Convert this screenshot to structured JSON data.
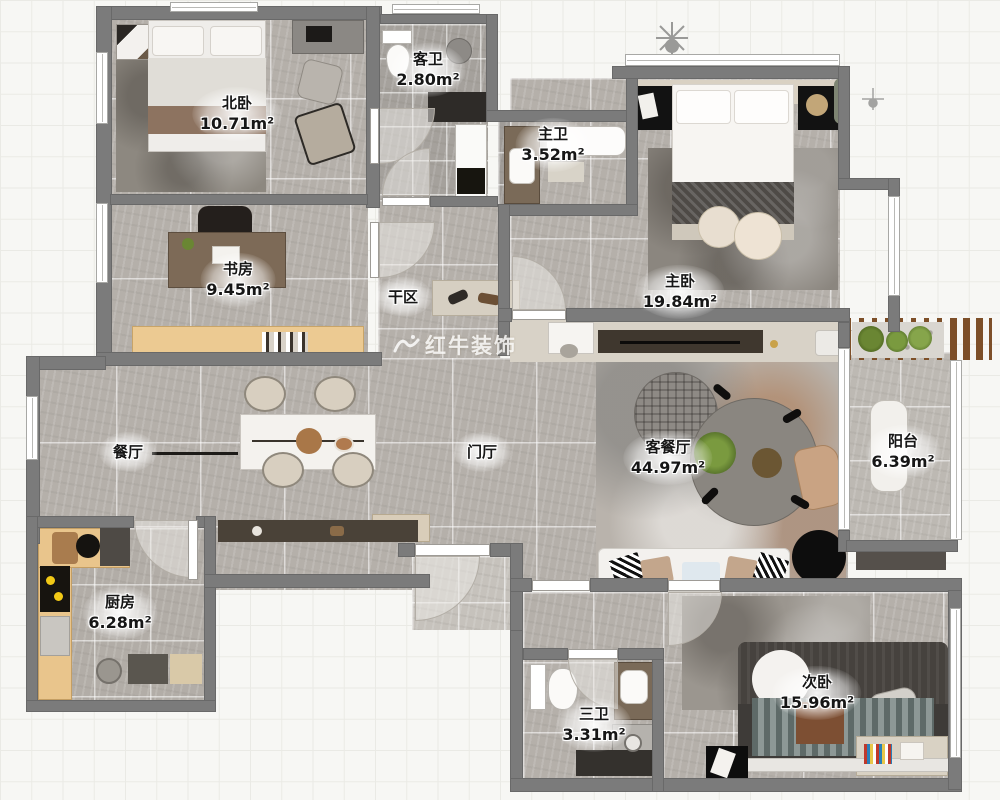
{
  "watermark": {
    "brand": "红牛装饰"
  },
  "rooms": [
    {
      "id": "north-bedroom",
      "label": "北卧",
      "area": "10.71m²"
    },
    {
      "id": "guest-bath",
      "label": "客卫",
      "area": "2.80m²"
    },
    {
      "id": "master-bath",
      "label": "主卫",
      "area": "3.52m²"
    },
    {
      "id": "master-bedroom",
      "label": "主卧",
      "area": "19.84m²"
    },
    {
      "id": "study",
      "label": "书房",
      "area": "9.45m²"
    },
    {
      "id": "dry-area",
      "label": "干区",
      "area": ""
    },
    {
      "id": "dining",
      "label": "餐厅",
      "area": ""
    },
    {
      "id": "foyer",
      "label": "门厅",
      "area": ""
    },
    {
      "id": "living-dining",
      "label": "客餐厅",
      "area": "44.97m²"
    },
    {
      "id": "balcony",
      "label": "阳台",
      "area": "6.39m²"
    },
    {
      "id": "kitchen",
      "label": "厨房",
      "area": "6.28m²"
    },
    {
      "id": "third-bath",
      "label": "三卫",
      "area": "3.31m²"
    },
    {
      "id": "second-bedroom",
      "label": "次卧",
      "area": "15.96m²"
    }
  ],
  "colors": {
    "wall": "#7b7b7b",
    "floor_tile": "#b5b0aa",
    "wood_cabinet": "#ecca92",
    "pergola_wood": "#7d4f28",
    "plant_green": "#6a8633",
    "label_text": "#161616",
    "watermark": "#ffffff"
  }
}
